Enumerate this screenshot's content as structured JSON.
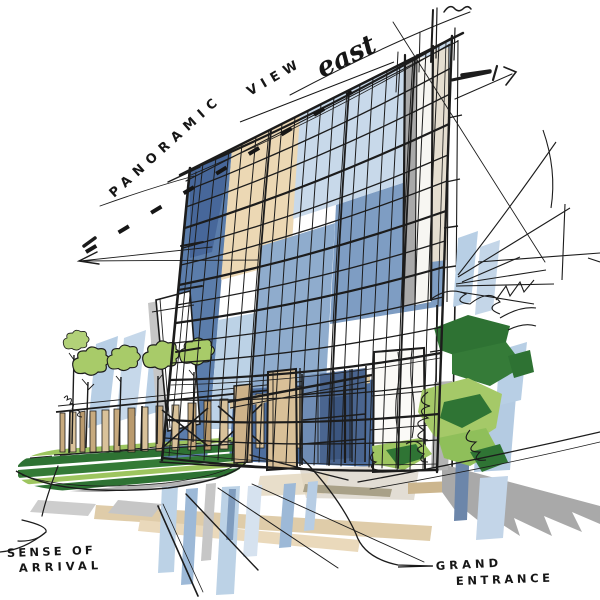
{
  "title": "Hand-drawn architectural concept sketch of a curved glass tower with landscaped arrival court",
  "annotations": {
    "panoramic_view": {
      "word1": "PANORAMIC",
      "word2": "VIEW",
      "script": "east"
    },
    "sense_of_arrival": {
      "line1": "SENSE OF",
      "line2": "ARRIVAL"
    },
    "grand_entrance": {
      "line1": "GRAND",
      "line2": "ENTRANCE"
    }
  },
  "palette": {
    "ink": "#1c1c1c",
    "glass_dark": "#47679a",
    "glass_steel": "#5b7dab",
    "glass_mid": "#8faccd",
    "glass_light": "#c8d9ea",
    "pale_blue": "#bcd2e6",
    "beige": "#ecd8b4",
    "tan": "#dcc7a0",
    "tan_dark": "#c7aa7e",
    "warm_gray": "#d9d3c6",
    "shadow_gray": "#ababab",
    "lawn_dark": "#2e7233",
    "lawn_light": "#9dc55f",
    "tree_green": "#a8cb69"
  },
  "scene": {
    "subject": "curved curtain-wall office tower, marker-and-ink rendering",
    "elements": [
      "glass curtain wall tower with curved floor bands",
      "dashed panoramic-view leader line with arrow",
      "right service pier with construction ticks",
      "grand entrance canopy with tan pylons and glass storefront",
      "colonnade fence with small trees",
      "striped lawn roundabout island",
      "loose foliage scribbles on the right",
      "sweeping driveway lines and foreground glass reflections"
    ]
  }
}
